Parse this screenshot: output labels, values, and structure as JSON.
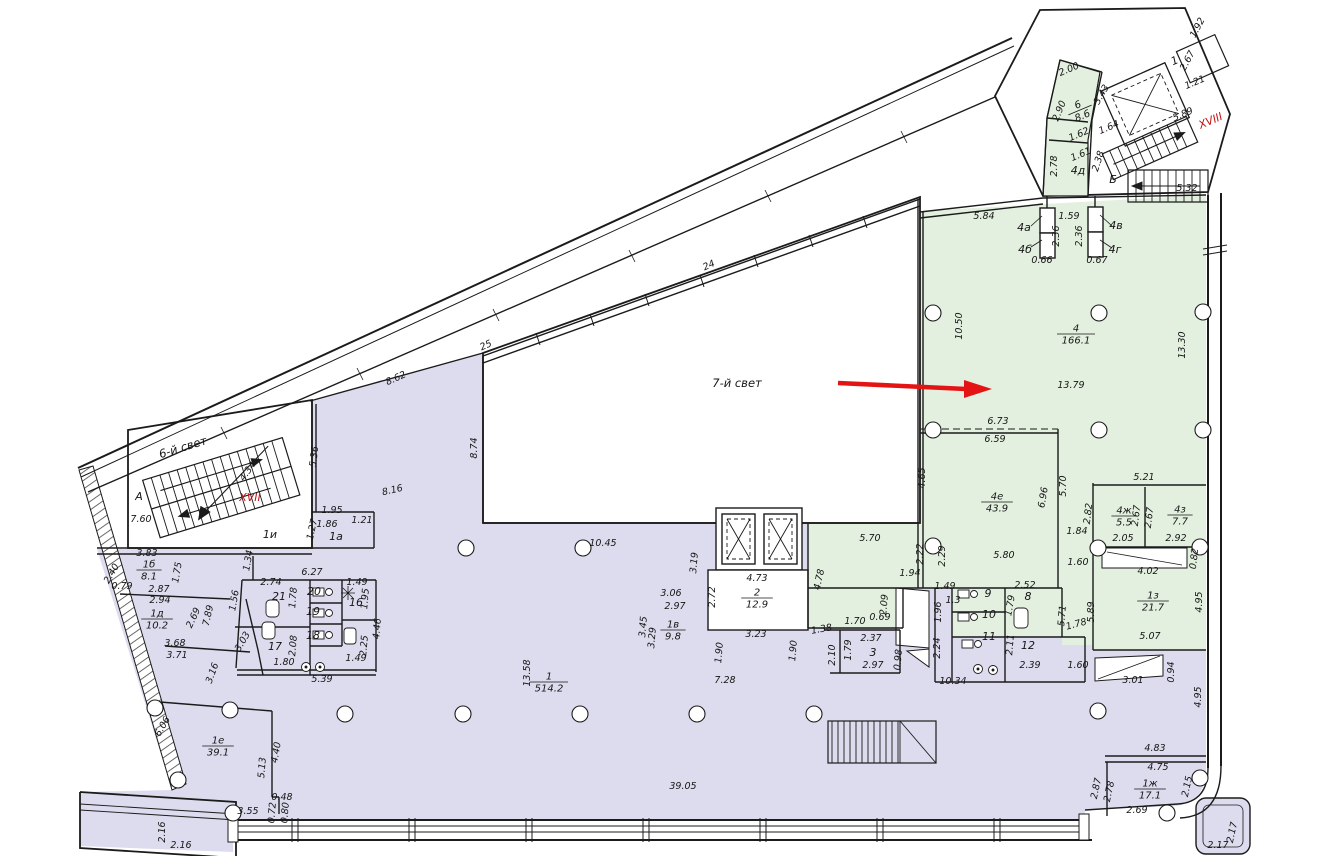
{
  "colors": {
    "purple": "#dcdcee",
    "green": "#e3efdf",
    "arrow_red": "#e41414",
    "label_red": "#c41212",
    "wall": "#1b1b1b",
    "bg": "#ffffff"
  },
  "zones": {
    "atrium": "7-й свет",
    "light6": "6-й свет",
    "stair_xvii": "XVII",
    "stair_xviii": "XVIII"
  },
  "rooms": [
    {
      "n": "6",
      "a": "8.6",
      "x": 1080,
      "y": 110,
      "r": -23
    },
    {
      "n": "4",
      "a": "166.1",
      "x": 1076,
      "y": 334
    },
    {
      "n": "4е",
      "a": "43.9",
      "x": 997,
      "y": 502
    },
    {
      "n": "4ж",
      "a": "5.5",
      "x": 1124,
      "y": 516
    },
    {
      "n": "4з",
      "a": "7.7",
      "x": 1180,
      "y": 515
    },
    {
      "n": "1з",
      "a": "21.7",
      "x": 1153,
      "y": 601
    },
    {
      "n": "1ж",
      "a": "17.1",
      "x": 1150,
      "y": 789
    },
    {
      "n": "1",
      "a": "514.2",
      "x": 549,
      "y": 682
    },
    {
      "n": "1б",
      "a": "8.1",
      "x": 149,
      "y": 570
    },
    {
      "n": "1д",
      "a": "10.2",
      "x": 157,
      "y": 619
    },
    {
      "n": "1е",
      "a": "39.1",
      "x": 218,
      "y": 746
    },
    {
      "n": "1в",
      "a": "9.8",
      "x": 673,
      "y": 630
    },
    {
      "n": "2",
      "a": "12.9",
      "x": 757,
      "y": 598
    }
  ],
  "labels": [
    {
      "t": "2.00",
      "x": 1070,
      "y": 72,
      "r": -23
    },
    {
      "t": "2.90",
      "x": 1062,
      "y": 112,
      "r": -68
    },
    {
      "t": "3.43",
      "x": 1104,
      "y": 96,
      "r": -60
    },
    {
      "t": "1.64",
      "x": 1110,
      "y": 130,
      "r": -23
    },
    {
      "t": "1.62",
      "x": 1080,
      "y": 137,
      "r": -23
    },
    {
      "t": "1.61",
      "x": 1082,
      "y": 157,
      "r": -23
    },
    {
      "t": "2.78",
      "x": 1057,
      "y": 166,
      "r": -90
    },
    {
      "t": "2.38",
      "x": 1101,
      "y": 162,
      "r": -72
    },
    {
      "t": "Б",
      "x": 1113,
      "y": 183,
      "c": "room"
    },
    {
      "t": "5.32",
      "x": 1187,
      "y": 191
    },
    {
      "t": "5.89",
      "x": 1184,
      "y": 117,
      "r": -23
    },
    {
      "t": "2.67",
      "x": 1190,
      "y": 62,
      "r": -62
    },
    {
      "t": "1",
      "x": 1176,
      "y": 64,
      "r": -23,
      "c": "room"
    },
    {
      "t": "1.21",
      "x": 1196,
      "y": 85,
      "r": -23
    },
    {
      "t": "1.92",
      "x": 1200,
      "y": 29,
      "r": -62
    },
    {
      "t": "5.84",
      "x": 984,
      "y": 219
    },
    {
      "t": "1.59",
      "x": 1069,
      "y": 219
    },
    {
      "t": "2.36",
      "x": 1059,
      "y": 236,
      "r": -90
    },
    {
      "t": "2.36",
      "x": 1082,
      "y": 236,
      "r": -90
    },
    {
      "t": "4а",
      "x": 1024,
      "y": 231,
      "c": "room"
    },
    {
      "t": "4б",
      "x": 1025,
      "y": 253,
      "c": "room"
    },
    {
      "t": "4в",
      "x": 1116,
      "y": 229,
      "c": "room"
    },
    {
      "t": "4г",
      "x": 1115,
      "y": 253,
      "c": "room"
    },
    {
      "t": "4д",
      "x": 1078,
      "y": 174,
      "c": "room"
    },
    {
      "t": "0.66",
      "x": 1042,
      "y": 263
    },
    {
      "t": "0.67",
      "x": 1097,
      "y": 263
    },
    {
      "t": "10.50",
      "x": 962,
      "y": 326,
      "r": -90
    },
    {
      "t": "13.30",
      "x": 1185,
      "y": 345,
      "r": -90
    },
    {
      "t": "13.79",
      "x": 1071,
      "y": 388
    },
    {
      "t": "6.73",
      "x": 998,
      "y": 424
    },
    {
      "t": "6.59",
      "x": 995,
      "y": 442
    },
    {
      "t": "4.65",
      "x": 925,
      "y": 478,
      "r": -90
    },
    {
      "t": "6.96",
      "x": 1046,
      "y": 498,
      "r": -80
    },
    {
      "t": "5.70",
      "x": 1066,
      "y": 486,
      "r": -90
    },
    {
      "t": "2.82",
      "x": 1091,
      "y": 514,
      "r": -83
    },
    {
      "t": "1.84",
      "x": 1077,
      "y": 534
    },
    {
      "t": "5.21",
      "x": 1144,
      "y": 480
    },
    {
      "t": "2.67",
      "x": 1139,
      "y": 516,
      "r": -83
    },
    {
      "t": "2.67",
      "x": 1152,
      "y": 518,
      "r": -83
    },
    {
      "t": "2.05",
      "x": 1123,
      "y": 541
    },
    {
      "t": "2.92",
      "x": 1176,
      "y": 541
    },
    {
      "t": "4.02",
      "x": 1148,
      "y": 574
    },
    {
      "t": "0.82",
      "x": 1197,
      "y": 559,
      "r": -83
    },
    {
      "t": "4.95",
      "x": 1202,
      "y": 602,
      "r": -90
    },
    {
      "t": "5.07",
      "x": 1150,
      "y": 639
    },
    {
      "t": "5.89",
      "x": 1094,
      "y": 612,
      "r": -90
    },
    {
      "t": "1.60",
      "x": 1078,
      "y": 565
    },
    {
      "t": "5.80",
      "x": 1004,
      "y": 558
    },
    {
      "t": "2.22",
      "x": 923,
      "y": 554,
      "r": -90
    },
    {
      "t": "2.29",
      "x": 945,
      "y": 556,
      "r": -90
    },
    {
      "t": "1.94",
      "x": 910,
      "y": 576
    },
    {
      "t": "5.70",
      "x": 870,
      "y": 541
    },
    {
      "t": "4.78",
      "x": 822,
      "y": 580,
      "r": -78
    },
    {
      "t": "2.09",
      "x": 887,
      "y": 605,
      "r": -85
    },
    {
      "t": "0.69",
      "x": 880,
      "y": 620
    },
    {
      "t": "1.70",
      "x": 855,
      "y": 624
    },
    {
      "t": "1.38",
      "x": 822,
      "y": 632,
      "r": -10
    },
    {
      "t": "2.10",
      "x": 835,
      "y": 655,
      "r": -90
    },
    {
      "t": "1.79",
      "x": 851,
      "y": 650,
      "r": -90
    },
    {
      "t": "2.37",
      "x": 871,
      "y": 641
    },
    {
      "t": "3",
      "x": 873,
      "y": 656,
      "c": "room"
    },
    {
      "t": "2.97",
      "x": 873,
      "y": 668
    },
    {
      "t": "0.98",
      "x": 901,
      "y": 660,
      "r": -85
    },
    {
      "t": "1.49",
      "x": 945,
      "y": 589
    },
    {
      "t": "1.3",
      "x": 953,
      "y": 603
    },
    {
      "t": "1.96",
      "x": 941,
      "y": 612,
      "r": -90
    },
    {
      "t": "2.24",
      "x": 940,
      "y": 648,
      "r": -90
    },
    {
      "t": "2.52",
      "x": 1025,
      "y": 588
    },
    {
      "t": "8",
      "x": 1028,
      "y": 600,
      "c": "room"
    },
    {
      "t": "9",
      "x": 988,
      "y": 597,
      "c": "room"
    },
    {
      "t": "10",
      "x": 989,
      "y": 618,
      "c": "room"
    },
    {
      "t": "11",
      "x": 989,
      "y": 640,
      "c": "room"
    },
    {
      "t": "12",
      "x": 1028,
      "y": 649,
      "c": "room"
    },
    {
      "t": "1.79",
      "x": 1013,
      "y": 606,
      "r": -80
    },
    {
      "t": "2.11",
      "x": 1013,
      "y": 645,
      "r": -85
    },
    {
      "t": "2.39",
      "x": 1030,
      "y": 668
    },
    {
      "t": "5.71",
      "x": 1065,
      "y": 616,
      "r": -85
    },
    {
      "t": "1.78",
      "x": 1077,
      "y": 627,
      "r": -15
    },
    {
      "t": "1.60",
      "x": 1078,
      "y": 668
    },
    {
      "t": "10.34",
      "x": 953,
      "y": 684
    },
    {
      "t": "3.01",
      "x": 1133,
      "y": 683
    },
    {
      "t": "0.94",
      "x": 1174,
      "y": 672,
      "r": -90
    },
    {
      "t": "4.95",
      "x": 1201,
      "y": 697,
      "r": -90
    },
    {
      "t": "4.83",
      "x": 1155,
      "y": 751
    },
    {
      "t": "4.75",
      "x": 1158,
      "y": 770
    },
    {
      "t": "2.87",
      "x": 1099,
      "y": 789,
      "r": -78
    },
    {
      "t": "2.78",
      "x": 1112,
      "y": 792,
      "r": -78
    },
    {
      "t": "2.15",
      "x": 1190,
      "y": 787,
      "r": -78
    },
    {
      "t": "2.69",
      "x": 1137,
      "y": 813
    },
    {
      "t": "2.17",
      "x": 1235,
      "y": 833,
      "r": -78
    },
    {
      "t": "2.17",
      "x": 1218,
      "y": 848
    },
    {
      "t": "24",
      "x": 710,
      "y": 268,
      "r": -24
    },
    {
      "t": "25",
      "x": 487,
      "y": 348,
      "r": -24
    },
    {
      "t": "8.62",
      "x": 397,
      "y": 381,
      "r": -24
    },
    {
      "t": "5.36",
      "x": 317,
      "y": 457,
      "r": -83
    },
    {
      "t": "8.74",
      "x": 477,
      "y": 448,
      "r": -90
    },
    {
      "t": "8.16",
      "x": 393,
      "y": 493,
      "r": -13
    },
    {
      "t": "10.45",
      "x": 603,
      "y": 546
    },
    {
      "t": "1.95",
      "x": 332,
      "y": 513
    },
    {
      "t": "1.86",
      "x": 327,
      "y": 527
    },
    {
      "t": "1.27",
      "x": 315,
      "y": 530,
      "r": -78
    },
    {
      "t": "1а",
      "x": 336,
      "y": 540,
      "c": "room"
    },
    {
      "t": "1и",
      "x": 270,
      "y": 538,
      "c": "room"
    },
    {
      "t": "1.21",
      "x": 362,
      "y": 523
    },
    {
      "t": "1.34",
      "x": 251,
      "y": 561,
      "r": -80
    },
    {
      "t": "3.83",
      "x": 147,
      "y": 556
    },
    {
      "t": "2.40",
      "x": 114,
      "y": 575,
      "r": -60
    },
    {
      "t": "0.79",
      "x": 122,
      "y": 589
    },
    {
      "t": "2.87",
      "x": 159,
      "y": 592
    },
    {
      "t": "2.94",
      "x": 160,
      "y": 603
    },
    {
      "t": "1.75",
      "x": 180,
      "y": 573,
      "r": -80
    },
    {
      "t": "2.69",
      "x": 196,
      "y": 619,
      "r": -65
    },
    {
      "t": "7.89",
      "x": 211,
      "y": 616,
      "r": -78
    },
    {
      "t": "3.68",
      "x": 175,
      "y": 646
    },
    {
      "t": "3.71",
      "x": 177,
      "y": 658
    },
    {
      "t": "3.03",
      "x": 245,
      "y": 643,
      "r": -60
    },
    {
      "t": "3.16",
      "x": 215,
      "y": 674,
      "r": -70
    },
    {
      "t": "6.06",
      "x": 165,
      "y": 728,
      "r": -60
    },
    {
      "t": "5.13",
      "x": 265,
      "y": 768,
      "r": -85
    },
    {
      "t": "4.40",
      "x": 279,
      "y": 753,
      "r": -80
    },
    {
      "t": "0.48",
      "x": 282,
      "y": 800
    },
    {
      "t": "0.72",
      "x": 275,
      "y": 813,
      "r": -85
    },
    {
      "t": "0.80",
      "x": 288,
      "y": 813,
      "r": -85
    },
    {
      "t": "3.55",
      "x": 248,
      "y": 814
    },
    {
      "t": "2.16",
      "x": 165,
      "y": 832,
      "r": -90
    },
    {
      "t": "2.16",
      "x": 181,
      "y": 848
    },
    {
      "t": "6.27",
      "x": 312,
      "y": 575
    },
    {
      "t": "2.74",
      "x": 271,
      "y": 585
    },
    {
      "t": "21",
      "x": 279,
      "y": 600,
      "c": "room"
    },
    {
      "t": "1.78",
      "x": 296,
      "y": 598,
      "r": -85
    },
    {
      "t": "20",
      "x": 314,
      "y": 595,
      "c": "room"
    },
    {
      "t": "19",
      "x": 313,
      "y": 615,
      "c": "room"
    },
    {
      "t": "18",
      "x": 313,
      "y": 639,
      "c": "room"
    },
    {
      "t": "16",
      "x": 356,
      "y": 606,
      "c": "room"
    },
    {
      "t": "17",
      "x": 275,
      "y": 650,
      "c": "room"
    },
    {
      "t": "1.49",
      "x": 357,
      "y": 585
    },
    {
      "t": "1.95",
      "x": 368,
      "y": 599,
      "r": -85
    },
    {
      "t": "4.46",
      "x": 380,
      "y": 629,
      "r": -85
    },
    {
      "t": "2.08",
      "x": 296,
      "y": 646,
      "r": -85
    },
    {
      "t": "2.25",
      "x": 367,
      "y": 646,
      "r": -85
    },
    {
      "t": "1.49",
      "x": 356,
      "y": 661
    },
    {
      "t": "1.80",
      "x": 284,
      "y": 665
    },
    {
      "t": "5.39",
      "x": 322,
      "y": 682
    },
    {
      "t": "1.56",
      "x": 237,
      "y": 601,
      "r": -80
    },
    {
      "t": "А",
      "x": 139,
      "y": 500,
      "c": "room"
    },
    {
      "t": "7.60",
      "x": 141,
      "y": 522
    },
    {
      "t": "4.34",
      "x": 250,
      "y": 473,
      "r": -55
    },
    {
      "t": "13.58",
      "x": 530,
      "y": 673,
      "r": -90
    },
    {
      "t": "39.05",
      "x": 683,
      "y": 789
    },
    {
      "t": "7.28",
      "x": 725,
      "y": 683
    },
    {
      "t": "3.23",
      "x": 756,
      "y": 637
    },
    {
      "t": "1.90",
      "x": 722,
      "y": 653,
      "r": -85
    },
    {
      "t": "1.90",
      "x": 796,
      "y": 651,
      "r": -85
    },
    {
      "t": "3.06",
      "x": 671,
      "y": 596
    },
    {
      "t": "2.97",
      "x": 675,
      "y": 609
    },
    {
      "t": "3.45",
      "x": 646,
      "y": 627,
      "r": -85
    },
    {
      "t": "3.29",
      "x": 655,
      "y": 638,
      "r": -85
    },
    {
      "t": "3.19",
      "x": 697,
      "y": 563,
      "r": -85
    },
    {
      "t": "2.72",
      "x": 715,
      "y": 597,
      "r": -90
    },
    {
      "t": "4.73",
      "x": 757,
      "y": 581
    }
  ]
}
